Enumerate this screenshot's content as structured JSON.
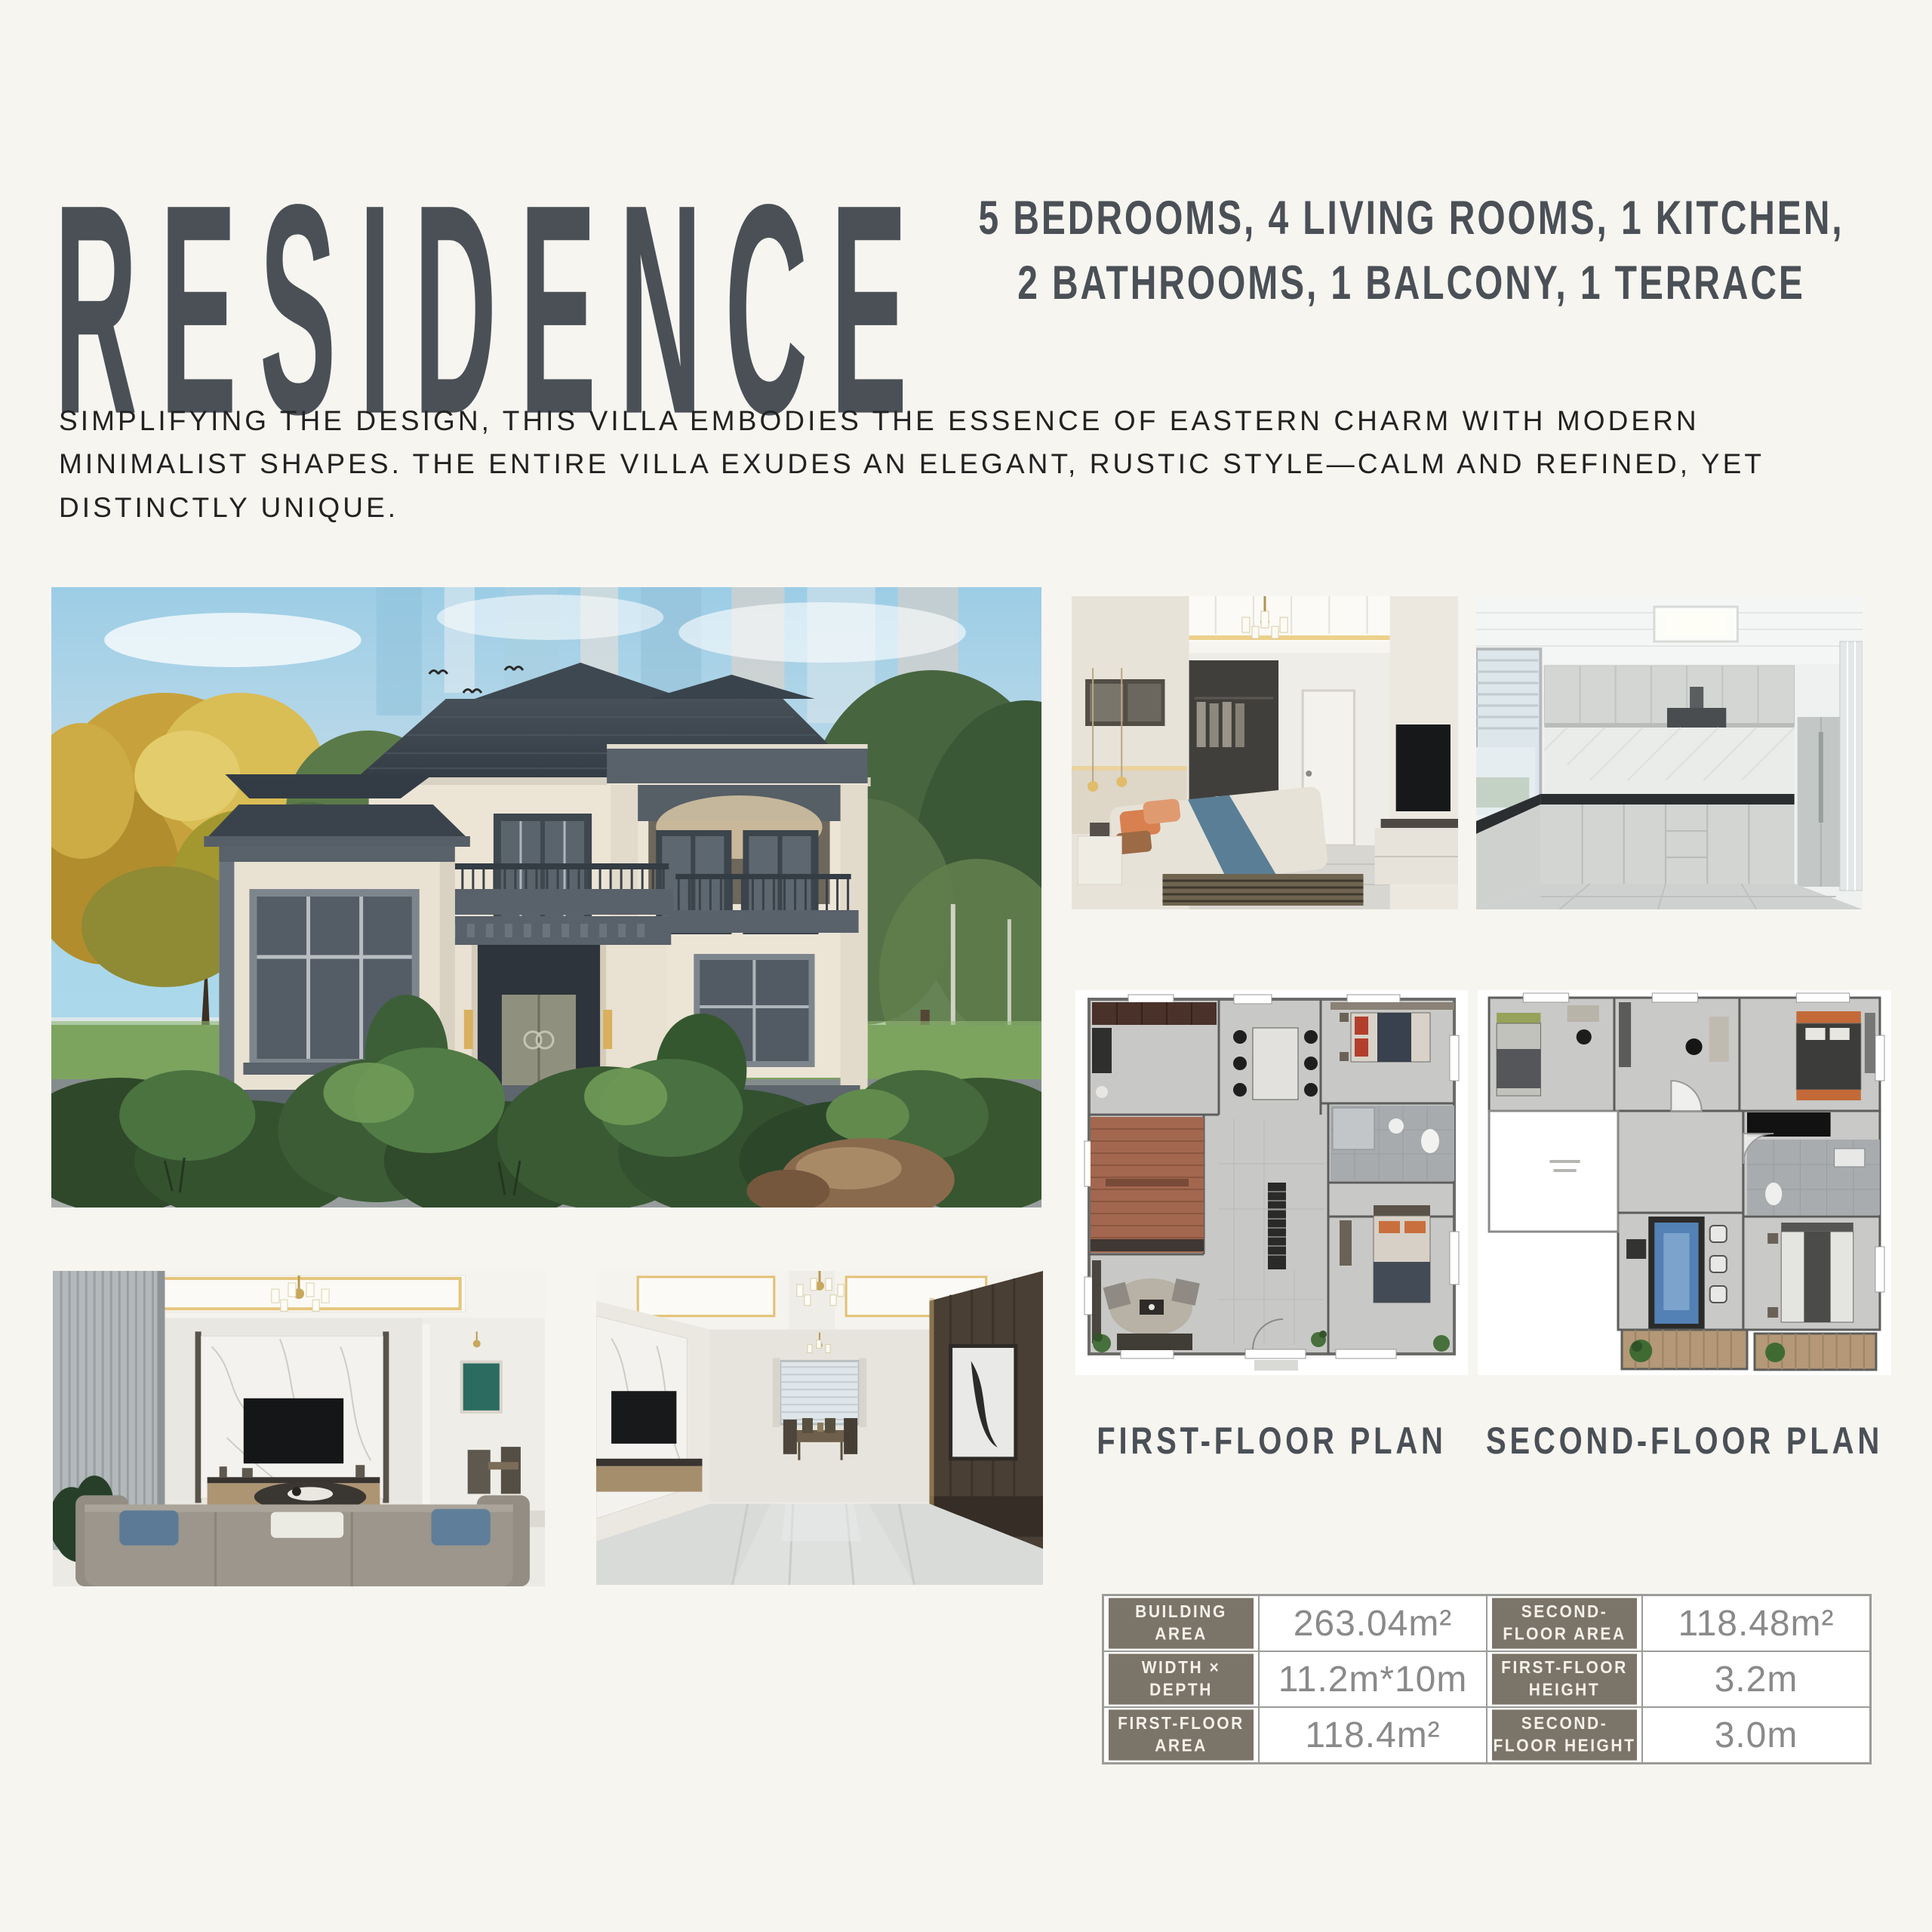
{
  "header": {
    "title": "RESIDENCE",
    "subtitle_line1": "5 BEDROOMS, 4 LIVING ROOMS, 1 KITCHEN,",
    "subtitle_line2": "2 BATHROOMS, 1 BALCONY, 1 TERRACE",
    "description": "SIMPLIFYING THE DESIGN, THIS VILLA EMBODIES THE ESSENCE OF EASTERN CHARM WITH MODERN MINIMALIST SHAPES. THE ENTIRE VILLA EXUDES AN ELEGANT, RUSTIC STYLE—CALM AND REFINED, YET DISTINCTLY UNIQUE."
  },
  "gallery": {
    "villa_exterior": "villa-exterior-rendering",
    "bedroom": "bedroom-interior-rendering",
    "kitchen": "kitchen-interior-rendering",
    "living_room_1": "living-room-interior-rendering",
    "living_room_2": "hallway-dining-interior-rendering",
    "first_floor_plan": "first-floor-plan-rendering",
    "second_floor_plan": "second-floor-plan-rendering"
  },
  "plans": {
    "first_label": "FIRST-FLOOR PLAN",
    "second_label": "SECOND-FLOOR PLAN"
  },
  "specs": {
    "cells": [
      {
        "label": "BUILDING AREA",
        "value": "263.04m²"
      },
      {
        "label": "SECOND-FLOOR AREA",
        "value": "118.48m²"
      },
      {
        "label": "WIDTH × DEPTH",
        "value": "11.2m*10m"
      },
      {
        "label": "FIRST-FLOOR HEIGHT",
        "value": "3.2m"
      },
      {
        "label": "FIRST-FLOOR AREA",
        "value": "118.4m²"
      },
      {
        "label": "SECOND-FLOOR HEIGHT",
        "value": "3.0m"
      }
    ]
  },
  "colors": {
    "page_bg": "#f7f5f0",
    "accent_dark": "#4a5056",
    "text_dark": "#222222",
    "table_label_bg": "#7b7468",
    "table_value_text": "#8a8a8a",
    "table_border": "#9b9b98"
  }
}
